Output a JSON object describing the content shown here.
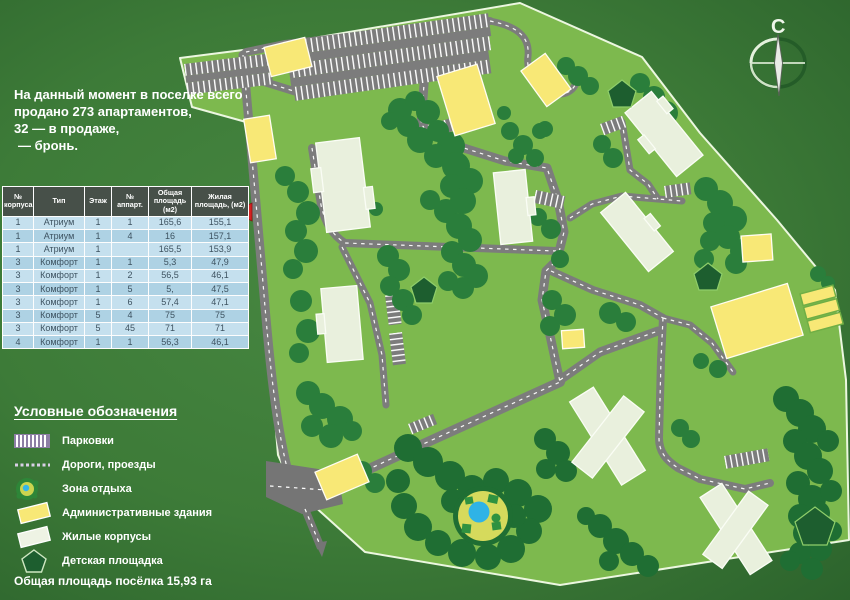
{
  "intro": {
    "lines": [
      "На данный момент в поселке всего",
      "продано 273 апартаментов,",
      "32 — в продаже,",
      "— бронь."
    ]
  },
  "table": {
    "headers": [
      "№ корпуса",
      "Тип",
      "Этаж",
      "№ аппарт.",
      "Общая площадь (м2)",
      "Жилая площадь, (м2)"
    ],
    "rows": [
      [
        "1",
        "Атриум",
        "1",
        "1",
        "165,6",
        "155,1"
      ],
      [
        "1",
        "Атриум",
        "1",
        "4",
        "16",
        "157,1"
      ],
      [
        "1",
        "Атриум",
        "1",
        "",
        "165,5",
        "153,9"
      ],
      [
        "3",
        "Комфорт",
        "1",
        "1",
        "5,3",
        "47,9"
      ],
      [
        "3",
        "Комфорт",
        "1",
        "2",
        "56,5",
        "46,1"
      ],
      [
        "3",
        "Комфорт",
        "1",
        "5",
        "5,",
        "47,5"
      ],
      [
        "3",
        "Комфорт",
        "1",
        "6",
        "57,4",
        "47,1"
      ],
      [
        "3",
        "Комфорт",
        "5",
        "4",
        "75",
        "75"
      ],
      [
        "3",
        "Комфорт",
        "5",
        "45",
        "71",
        "71"
      ],
      [
        "4",
        "Комфорт",
        "1",
        "1",
        "56,3",
        "46,1"
      ]
    ]
  },
  "legend": {
    "title": "Условные обозначения",
    "items": [
      {
        "icon": "parking-icon",
        "label": "Парковки"
      },
      {
        "icon": "road-icon",
        "label": "Дороги, проезды"
      },
      {
        "icon": "recreation-icon",
        "label": "Зона отдыха"
      },
      {
        "icon": "admin-building-icon",
        "label": "Административные здания"
      },
      {
        "icon": "residential-building-icon",
        "label": "Жилые корпусы"
      },
      {
        "icon": "playground-icon",
        "label": "Детская площадка"
      }
    ]
  },
  "footer": {
    "total_area": "Общая площадь посёлка 15,93 га"
  },
  "compass": {
    "north_label": "С"
  },
  "colors": {
    "background_green": "#3d7b38",
    "site_green": "#7db94e",
    "boundary_white": "#ecf7e0",
    "tree_green": "#2a7e3b",
    "tree_green_dark": "#1f6e33",
    "road_gray": "#7c7c7c",
    "residential_fill": "#e9f0dd",
    "admin_yellow": "#f8e876",
    "playground_green": "#1d5e2f",
    "pond_blue": "#2fb3e6",
    "recreation_yellow": "#d6da5c",
    "table_header_bg": "#475049",
    "table_row_light": "#c5e0ee",
    "table_row_dark": "#aed2e4",
    "marker_red": "#d52121"
  }
}
